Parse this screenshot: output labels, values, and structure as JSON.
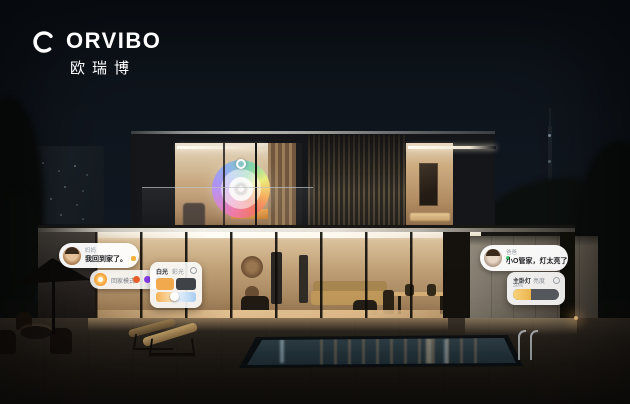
{
  "brand": {
    "logo_text": "ORVIBO",
    "logo_text_cn": "欧瑞博",
    "logo_color": "#ffffff"
  },
  "ui": {
    "bubble_mom": {
      "name": "妈妈",
      "message": "我回到家了。"
    },
    "scene_pill": {
      "label": "回家模式",
      "icon": "sun-icon",
      "light_colors": [
        "#E85C2A",
        "#8B3FF5",
        "#3A8DF0"
      ]
    },
    "panel_living": {
      "tab_white": "白光",
      "tab_color": "彩光",
      "swatches": {
        "brightness_on": "#F2A94E",
        "brightness_off": "#3F4347",
        "warm_gradient": [
          "#F5B055",
          "#FBE4BB"
        ],
        "cool_gradient": [
          "#EEF4FB",
          "#A8CDF0"
        ]
      }
    },
    "bubble_dad": {
      "name": "爸爸",
      "message": "小O管家，灯太亮了"
    },
    "panel_bedroom": {
      "title": "主卧灯",
      "label": "亮度",
      "value": "30%",
      "slider_fill_color": "#ECB44E",
      "slider_fill_percent": 40
    },
    "color_wheel": {
      "type": "hue-wheel",
      "hues_clockwise_from_top": [
        "#B48CF5",
        "#8FB0F2",
        "#7ED6AD",
        "#EEF07E",
        "#F7B155",
        "#F2705C",
        "#EF77AD"
      ]
    }
  },
  "scene_colors": {
    "sky": "#10161C",
    "interior_warm": "#BF9F76",
    "pool_water": "#273840",
    "accent_step_light": "#FFCF8A"
  }
}
